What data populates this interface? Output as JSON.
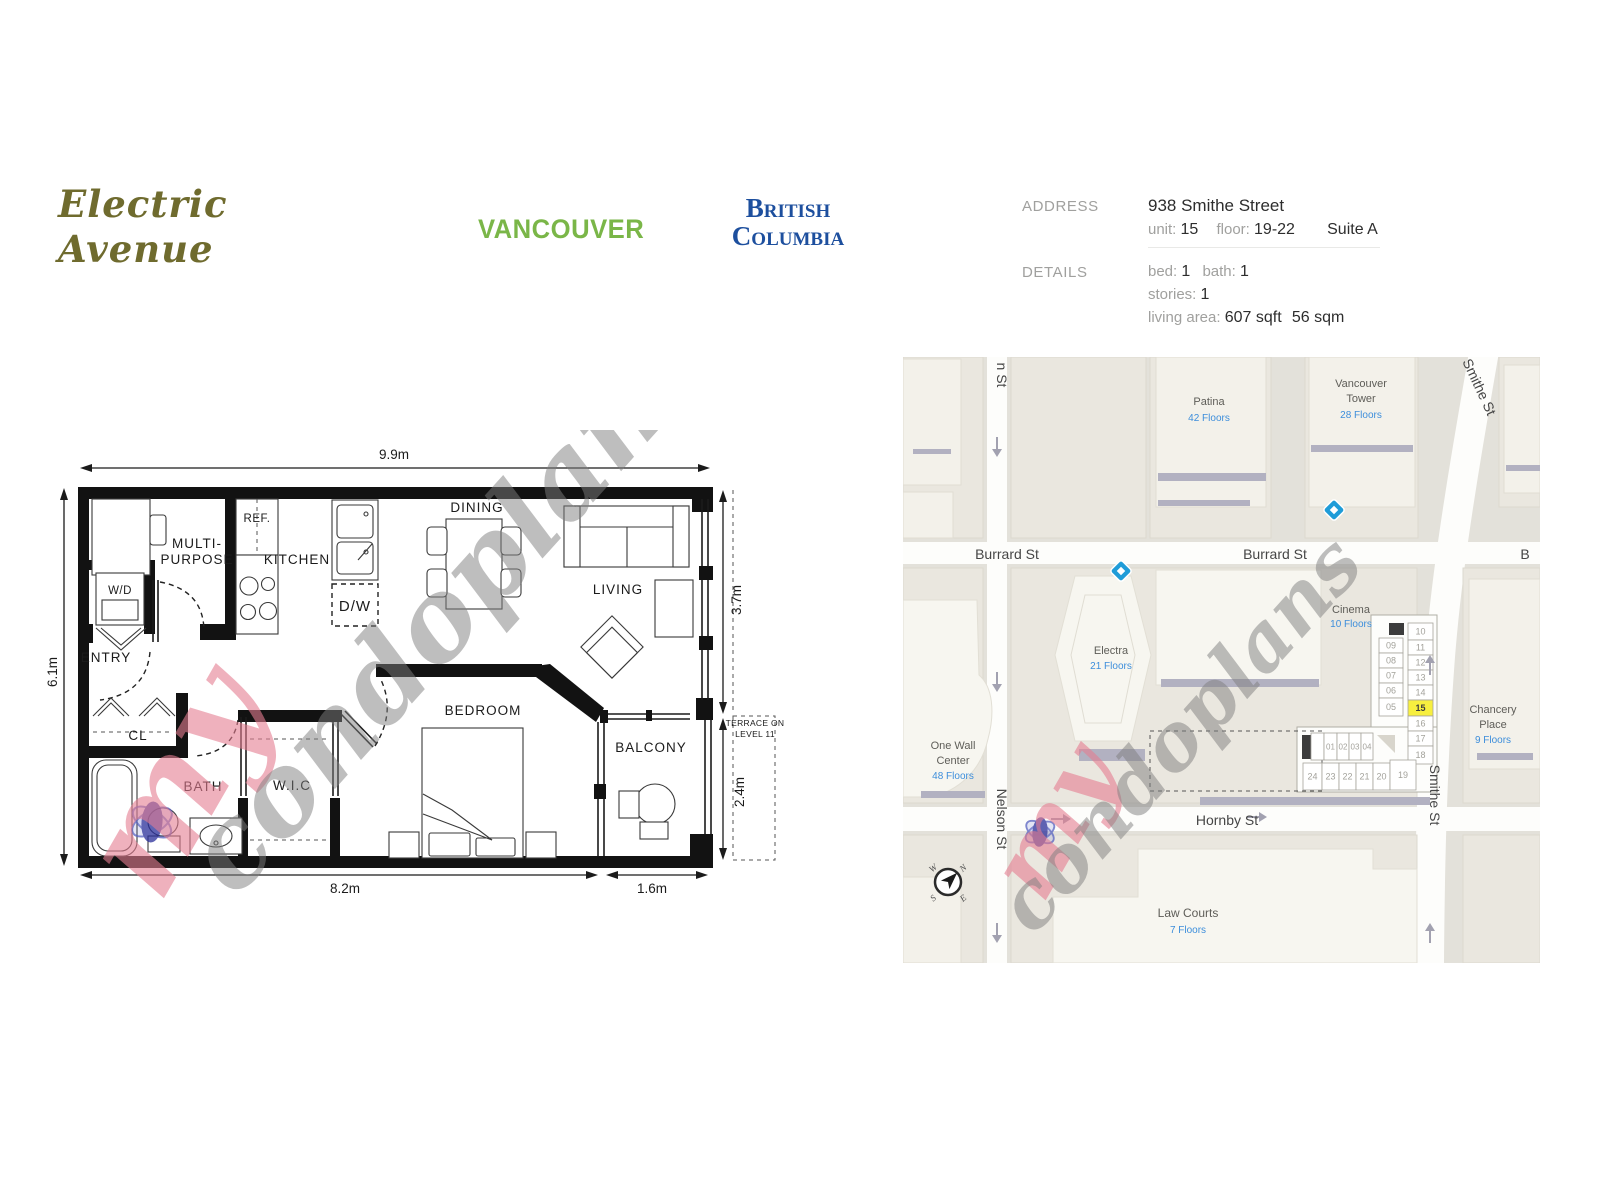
{
  "header": {
    "project_line1": "Electric",
    "project_line2": "Avenue",
    "city": "VANCOUVER",
    "province_line1": "British",
    "province_line2": "Columbia"
  },
  "info": {
    "address_label": "ADDRESS",
    "address": "938 Smithe Street",
    "unit_key": "unit:",
    "unit_value": "15",
    "floor_key": "floor:",
    "floor_value": "19-22",
    "suite": "Suite A",
    "details_label": "DETAILS",
    "bed_key": "bed:",
    "bed_value": "1",
    "bath_key": "bath:",
    "bath_value": "1",
    "stories_key": "stories:",
    "stories_value": "1",
    "area_key": "living area:",
    "area_sqft": "607 sqft",
    "area_sqm": "56 sqm"
  },
  "floorplan": {
    "labels": {
      "multi1": "MULTI-",
      "multi2": "PURPOSE",
      "wd": "W/D",
      "entry": "ENTRY",
      "cl": "CL",
      "bath": "BATH",
      "wic": "W.I.C",
      "kitchen": "KITCHEN",
      "ref": "REF.",
      "dw": "D/W",
      "dining": "DINING",
      "living": "LIVING",
      "bedroom": "BEDROOM",
      "balcony": "BALCONY"
    },
    "dimensions": {
      "top": "9.9m",
      "left": "6.1m",
      "right_upper": "3.7m",
      "right_lower": "2.4m",
      "bottom_main": "8.2m",
      "bottom_balcony": "1.6m"
    },
    "terrace_note_line1": "TERRACE ON",
    "terrace_note_line2": "LEVEL 11"
  },
  "map": {
    "street_labels": {
      "burrard_1": "Burrard St",
      "burrard_2": "Burrard St",
      "burrard_partial": "B",
      "nelson": "Nelson St",
      "nelson_partial": "n St",
      "hornby": "Hornby St",
      "smithe_top": "Smithe St",
      "smithe_right": "Smithe St"
    },
    "buildings": {
      "patina": {
        "name": "Patina",
        "floors": "42 Floors"
      },
      "vancouver_tower": {
        "name_line1": "Vancouver",
        "name_line2": "Tower",
        "floors": "28 Floors"
      },
      "electra": {
        "name": "Electra",
        "floors": "21 Floors"
      },
      "cinema": {
        "name": "Cinema",
        "floors": "10 Floors"
      },
      "one_wall_center": {
        "name_line1": "One Wall",
        "name_line2": "Center",
        "floors": "48 Floors"
      },
      "chancery_place": {
        "name_line1": "Chancery",
        "name_line2": "Place",
        "floors": "9 Floors"
      },
      "law_courts": {
        "name": "Law Courts",
        "floors": "7 Floors"
      }
    },
    "compass": {
      "n": "N",
      "e": "E",
      "s": "S",
      "w": "W"
    },
    "unit_plan": {
      "right_column": [
        "10",
        "11",
        "12",
        "13",
        "14",
        "15",
        "16",
        "17",
        "18"
      ],
      "left_column": [
        "09",
        "08",
        "07",
        "06",
        "05"
      ],
      "wing_top_row": [
        "01",
        "02",
        "03",
        "04"
      ],
      "wing_bottom_row": [
        "24",
        "23",
        "22",
        "21",
        "20",
        "19"
      ],
      "highlighted_unit": "15"
    }
  },
  "watermark": {
    "prefix": "my",
    "rest": "condoplans"
  },
  "colors": {
    "title_olive": "#6f6b2e",
    "vancouver_green": "#7ab648",
    "bc_blue": "#1d4f9e",
    "floors_blue": "#3d8edb",
    "highlight_yellow": "#f7ef3f",
    "map_background": "#e3e1da",
    "block_beige": "#eae7df",
    "watermark_pink": "rgba(228,125,145,0.6)",
    "watermark_gray": "rgba(125,125,125,0.5)"
  }
}
